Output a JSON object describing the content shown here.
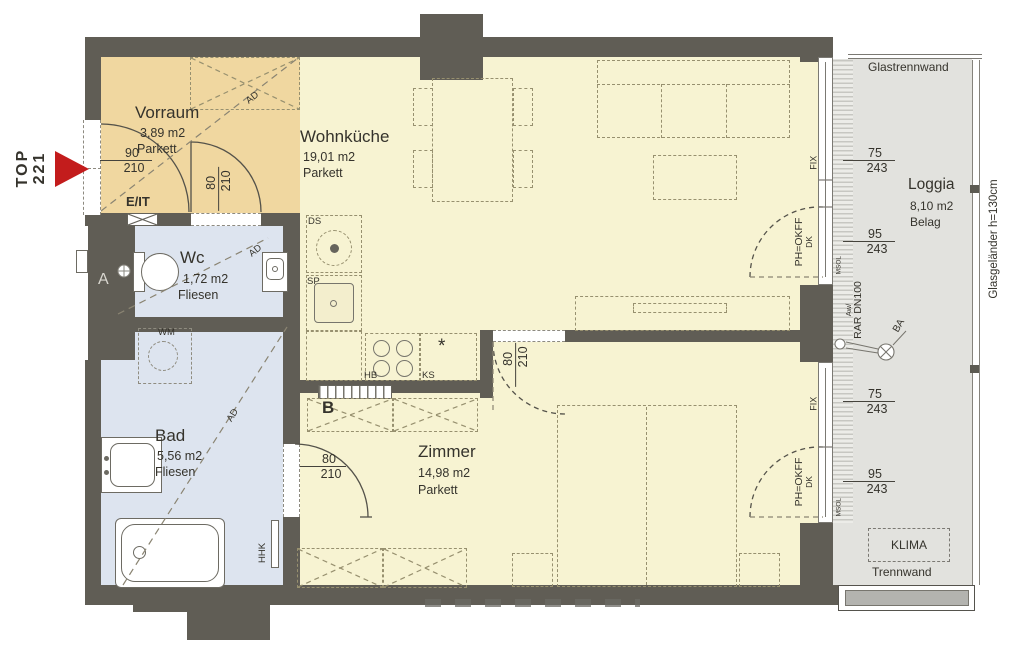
{
  "unit": {
    "label": "TOP",
    "number": "221"
  },
  "rooms": {
    "vorraum": {
      "name": "Vorraum",
      "area": "3,89  m2",
      "floor": "Parkett"
    },
    "wohnkueche": {
      "name": "Wohnküche",
      "area": "19,01  m2",
      "floor": "Parkett"
    },
    "wc": {
      "name": "Wc",
      "area": "1,72  m2",
      "floor": "Fliesen"
    },
    "bad": {
      "name": "Bad",
      "area": "5,56  m2",
      "floor": "Fliesen"
    },
    "zimmer": {
      "name": "Zimmer",
      "area": "14,98 m2",
      "floor": "Parkett"
    },
    "loggia": {
      "name": "Loggia",
      "area": "8,10  m2",
      "floor": "Belag"
    }
  },
  "doors": {
    "entrance": {
      "width": "90",
      "height": "210"
    },
    "wc_door": {
      "width": "80",
      "height": "210"
    },
    "bad_door": {
      "width": "80",
      "height": "210"
    },
    "zimmer_door": {
      "width": "80",
      "height": "210"
    },
    "balcony": {
      "label": "PH=OKFF",
      "sublabel": "DK"
    }
  },
  "windows": {
    "fix": "FIX",
    "upper_fix": {
      "width": "75",
      "height": "243"
    },
    "upper_door": {
      "width": "95",
      "height": "243"
    },
    "lower_fix": {
      "width": "75",
      "height": "243"
    },
    "lower_door": {
      "width": "95",
      "height": "243"
    }
  },
  "annotations": {
    "eit": "E/IT",
    "ad": "AD",
    "wm": "WM",
    "hhk": "HHK",
    "ds": "DS",
    "sp": "SP",
    "hb": "HB",
    "ks": "KS",
    "ks_star": "*",
    "section_a": "A",
    "section_b": "B",
    "glastrennwand": "Glastrennwand",
    "glasgelaender": "Glasgeländer  h=130cm",
    "klima": "KLIMA",
    "trennwand": "Trennwand",
    "aw": "Aw/",
    "rar": "RAR DN100",
    "ba": "BA",
    "msol": "MSOL"
  }
}
